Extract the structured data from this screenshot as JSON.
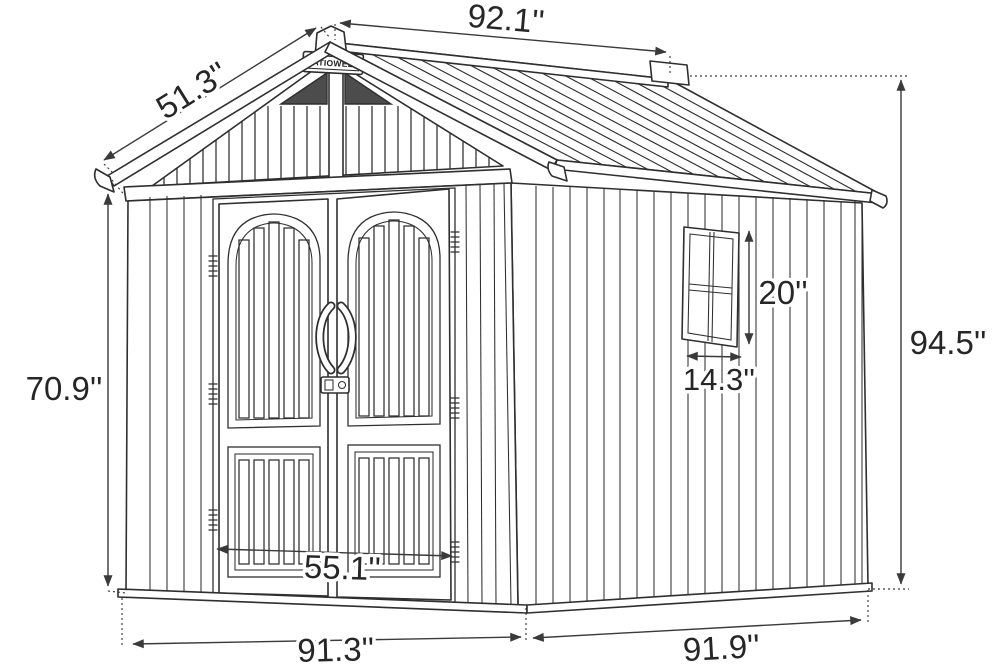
{
  "diagram": {
    "brand_label": "PATIOWELL",
    "dimensions": {
      "ridge_length": "92.1''",
      "roof_slope_width": "51.3''",
      "front_wall_height": "70.9''",
      "overall_height": "94.5''",
      "window_height": "20''",
      "window_width": "14.3''",
      "door_opening_width": "55.1''",
      "base_front_width": "91.3''",
      "base_side_depth": "91.9''"
    }
  }
}
